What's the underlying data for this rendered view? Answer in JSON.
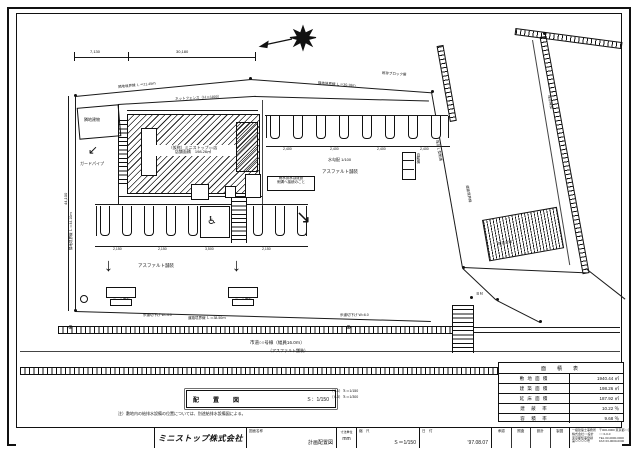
{
  "drawing": {
    "dims": {
      "top_a": "7,130",
      "top_b": "30,180",
      "left_v": "44,100",
      "stall_top": [
        "2,400",
        "2,400",
        "2,400",
        "2,400"
      ],
      "stall_bottom": [
        "2,150",
        "2,150",
        "3,500",
        "2,150"
      ]
    },
    "boundaries": {
      "top_left": "隣地境界線 Ｌ＝21.45ｍ",
      "top_right": "隣地境界線 Ｌ＝30.18ｍ",
      "left": "隣地境界線 Ｌ＝44.10ｍ",
      "bottom": "道路境界線 Ｌ＝38.50ｍ",
      "right": "道路境界線"
    },
    "building": {
      "line1": "（仮称）ミニストップ○○店",
      "line2": "店舗面積　198.26㎡"
    },
    "labels": {
      "fence": "ネットフェンス（Ｈ＝1800）",
      "block": "既存ブロック塀",
      "paving1": "アスファルト舗装",
      "paving2": "アスファルト舗装",
      "slope_note": "水勾配 1/100",
      "neighbor": "隣地建物",
      "guard": "ガードパイプ",
      "vending": "自販機",
      "sign1": "ポール看板",
      "sign2": "ポール看板",
      "note_line1": "雨水排水は既設",
      "note_line2": "側溝へ接続のこと",
      "curb1": "歩道切下げ W=4.0",
      "curb2": "歩道切下げ W=6.0",
      "gutter": "既存Ｌ型側溝",
      "wall_right": "既存擁壁",
      "slope_right": "既存法面",
      "bm": "ＢＭ"
    },
    "road": {
      "name": "市道○○号線（幅員16.0ｍ）",
      "surface": "（アスファルト舗装）"
    },
    "legend": {
      "box_title": "配　置　図",
      "box_scale": "Ｓ：1/150",
      "side1": "（Ａ1）Ｓ＝1/150",
      "side2": "（Ａ3）Ｓ＝1/300",
      "note": "注）敷地内の給排水設備の位置については、別途給排水設備図による。"
    },
    "area_table": {
      "title": "面　積　表",
      "rows": [
        {
          "label": "敷 地 面 積",
          "value": "1940.44 ㎡"
        },
        {
          "label": "建 築 面 積",
          "value": "198.26 ㎡"
        },
        {
          "label": "延 床 面 積",
          "value": "187.92 ㎡"
        },
        {
          "label": "建　蔽　率",
          "value": "10.22 ％"
        },
        {
          "label": "容　積　率",
          "value": "9.68 ％"
        }
      ]
    },
    "title_block": {
      "logo": "ミニストップ株式会社",
      "name_label": "図面名称",
      "name_value": "計画配置図",
      "unit_label": "寸法単位",
      "unit_value": "mm",
      "scale_label": "縮　尺",
      "scale_value": "Ｓ＝1/150",
      "date_label": "日　付",
      "date_value": "’97.08.07",
      "approval": [
        "承認",
        "照査",
        "設計",
        "製図"
      ],
      "office": [
        "一級建築士事務所",
        "株式会社○○設計",
        "東京都知事登録",
        "第００００号"
      ],
      "office2": [
        "〒000-0000 東京都○○区",
        "○○ 0-0-0",
        "TEL 03-0000-0000",
        "FAX 03-0000-0000"
      ]
    }
  }
}
